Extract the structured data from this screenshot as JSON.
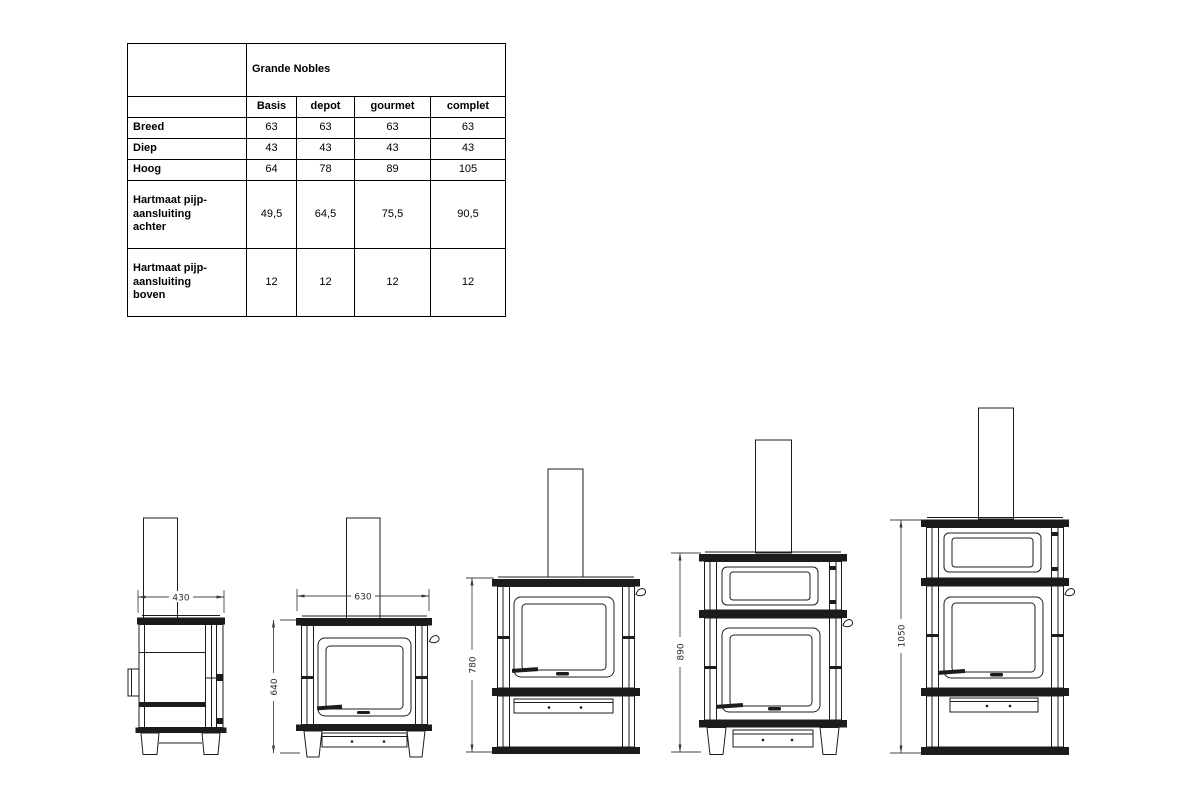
{
  "page": {
    "background": "#ffffff",
    "ink": "#1c1c1c"
  },
  "table": {
    "title": "Grande Nobles",
    "columns": [
      "Basis",
      "depot",
      "gourmet",
      "complet"
    ],
    "rows": [
      {
        "label": "Breed",
        "values": [
          "63",
          "63",
          "63",
          "63"
        ]
      },
      {
        "label": "Diep",
        "values": [
          "43",
          "43",
          "43",
          "43"
        ]
      },
      {
        "label": "Hoog",
        "values": [
          "64",
          "78",
          "89",
          "105"
        ]
      },
      {
        "label": "Hartmaat pijp-\naansluiting\nachter",
        "values": [
          "49,5",
          "64,5",
          "75,5",
          "90,5"
        ]
      },
      {
        "label": "Hartmaat pijp-\naansluiting\nboven",
        "values": [
          "12",
          "12",
          "12",
          "12"
        ]
      }
    ]
  },
  "figures": [
    {
      "width_label": "430"
    },
    {
      "width_label": "630",
      "height_label": "640"
    },
    {
      "height_label": "780"
    },
    {
      "height_label": "890"
    },
    {
      "height_label": "1050"
    }
  ]
}
